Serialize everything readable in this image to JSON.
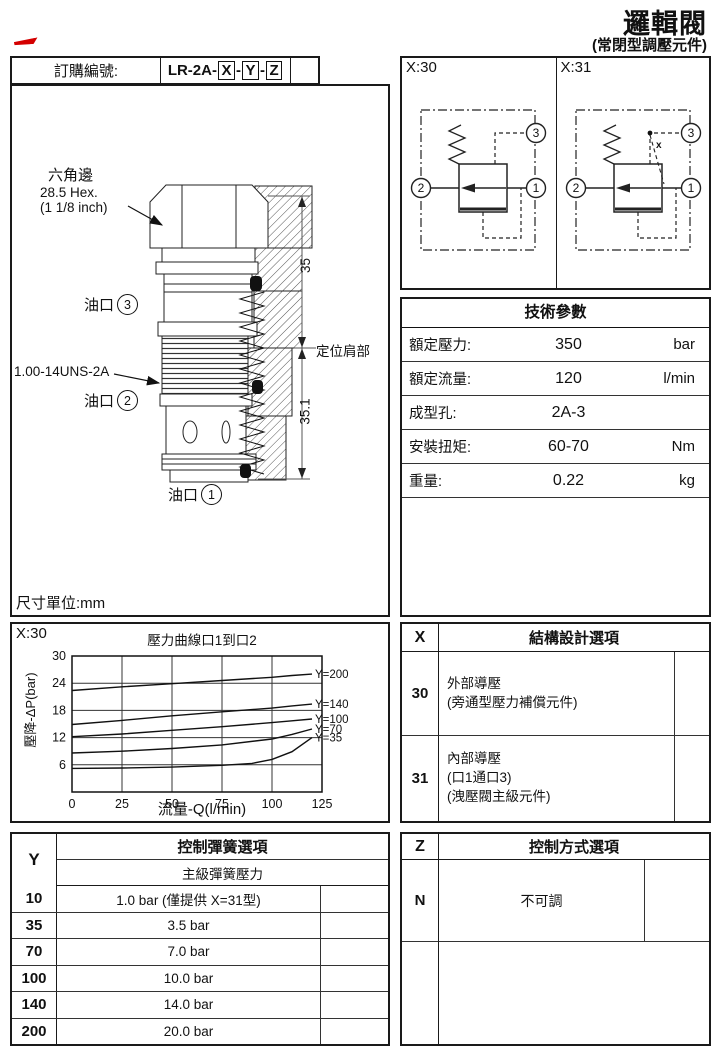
{
  "page": {
    "title": "邏輯閥",
    "subtitle": "(常閉型調壓元件)"
  },
  "colors": {
    "annotation_red": "#d40000",
    "line_black": "#111111"
  },
  "order": {
    "label": "訂購編號:",
    "code_prefix": "LR-2A-",
    "sep": "-",
    "code_x": "X",
    "code_y": "Y",
    "code_z": "Z"
  },
  "drawing": {
    "hex_label_cn": "六角邊",
    "hex_label_size": "28.5 Hex.",
    "hex_label_inch": "(1 1/8 inch)",
    "port3_label": "油口",
    "port3_num": "3",
    "thread_label": "1.00-14UNS-2A",
    "port2_label": "油口",
    "port2_num": "2",
    "port1_label": "油口",
    "port1_num": "1",
    "dim_upper": "35",
    "dim_lower": "35.1",
    "shoulder_label": "定位肩部",
    "units_note": "尺寸單位:mm"
  },
  "symbols": {
    "left_label": "X:30",
    "right_label": "X:31",
    "port1": "1",
    "port2": "2",
    "port3": "3",
    "x_mark": "x"
  },
  "tech_params": {
    "title": "技術參數",
    "rows": [
      {
        "label": "額定壓力:",
        "value": "350",
        "unit": "bar"
      },
      {
        "label": "額定流量:",
        "value": "120",
        "unit": "l/min"
      },
      {
        "label": "成型孔:",
        "value": "2A-3",
        "unit": ""
      },
      {
        "label": "安裝扭矩:",
        "value": "60-70",
        "unit": "Nm"
      },
      {
        "label": "重量:",
        "value": "0.22",
        "unit": "kg"
      }
    ]
  },
  "chart_section": {
    "corner_label": "X:30"
  },
  "chart_data": {
    "type": "line",
    "title": "壓力曲線口1到口2",
    "xlabel": "流量-Q(l/min)",
    "ylabel": "壓降-ΔP(bar)",
    "xlim": [
      0,
      125
    ],
    "ylim": [
      0,
      30
    ],
    "xticks": [
      0,
      25,
      50,
      75,
      100,
      125
    ],
    "yticks": [
      6,
      12,
      18,
      24,
      30
    ],
    "grid": true,
    "legend_position": "right-of-curves",
    "series": [
      {
        "name": "Y=200",
        "x": [
          0,
          25,
          50,
          75,
          100,
          110,
          120
        ],
        "y": [
          22.4,
          23.2,
          23.9,
          24.6,
          25.3,
          25.7,
          26.0
        ]
      },
      {
        "name": "Y=140",
        "x": [
          0,
          25,
          50,
          75,
          100,
          110,
          120
        ],
        "y": [
          14.9,
          15.8,
          16.8,
          17.7,
          18.5,
          19.0,
          19.4
        ]
      },
      {
        "name": "Y=100",
        "x": [
          0,
          25,
          50,
          75,
          100,
          110,
          120
        ],
        "y": [
          12.2,
          12.8,
          13.6,
          14.4,
          15.3,
          15.7,
          16.1
        ]
      },
      {
        "name": "Y=70",
        "x": [
          0,
          25,
          50,
          75,
          100,
          110,
          120
        ],
        "y": [
          8.6,
          9.0,
          9.6,
          10.4,
          11.7,
          12.7,
          13.9
        ]
      },
      {
        "name": "Y=35",
        "x": [
          0,
          25,
          50,
          75,
          90,
          100,
          110,
          120
        ],
        "y": [
          5.2,
          5.3,
          5.5,
          5.9,
          6.3,
          7.2,
          8.9,
          12.0
        ]
      }
    ]
  },
  "x_table": {
    "col_header": "X",
    "title": "結構設計選項",
    "rows": [
      {
        "code": "30",
        "desc_lines": [
          "外部導壓",
          "(旁通型壓力補償元件)",
          ""
        ]
      },
      {
        "code": "31",
        "desc_lines": [
          "內部導壓",
          "(口1通口3)",
          "(洩壓閥主級元件)"
        ]
      }
    ]
  },
  "y_table": {
    "col_header": "Y",
    "title": "控制彈簧選項",
    "subtitle": "主級彈簧壓力",
    "rows": [
      {
        "code": "10",
        "value": "1.0 bar  (僅提供 X=31型)"
      },
      {
        "code": "35",
        "value": "3.5 bar"
      },
      {
        "code": "70",
        "value": "7.0 bar"
      },
      {
        "code": "100",
        "value": "10.0 bar"
      },
      {
        "code": "140",
        "value": "14.0 bar"
      },
      {
        "code": "200",
        "value": "20.0 bar"
      }
    ]
  },
  "z_table": {
    "col_header": "Z",
    "title": "控制方式選項",
    "rows": [
      {
        "code": "N",
        "value": "不可調"
      }
    ]
  }
}
